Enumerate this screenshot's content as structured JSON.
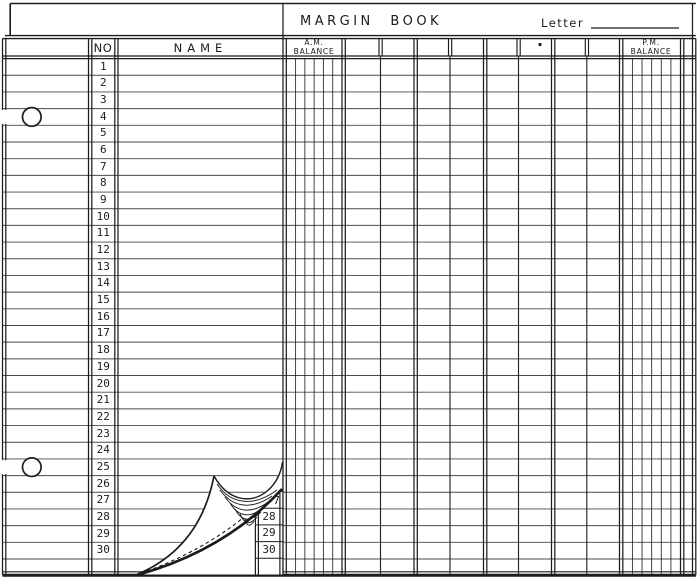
{
  "title_band": {
    "title": "MARGIN BOOK",
    "letter_label": "Letter"
  },
  "header": {
    "no": "NO",
    "name": "NAME",
    "am_line1": "A.M.",
    "am_line2": "BALANCE",
    "pm_line1": "P.M.",
    "pm_line2": "BALANCE"
  },
  "rows": [
    "1",
    "2",
    "3",
    "4",
    "5",
    "6",
    "7",
    "8",
    "9",
    "10",
    "11",
    "12",
    "13",
    "14",
    "15",
    "16",
    "17",
    "18",
    "19",
    "20",
    "21",
    "22",
    "23",
    "24",
    "25",
    "26",
    "27",
    "28",
    "29",
    "30"
  ],
  "under_page": {
    "partial_row": "7",
    "rows": [
      "28",
      "29",
      "30"
    ]
  },
  "colors": {
    "ink": "#1c1c1c",
    "paper": "#ffffff"
  }
}
